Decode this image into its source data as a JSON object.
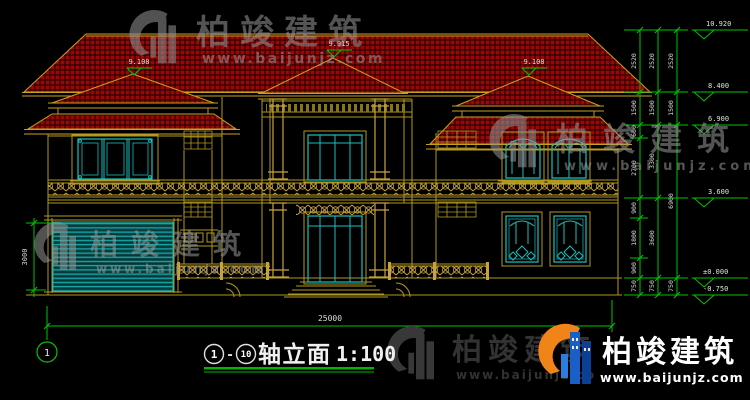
{
  "watermark": {
    "brand": "柏竣建筑",
    "url": "www.baijunjz.com"
  },
  "logo": {
    "brand": "柏竣建筑",
    "url": "www.baijunjz.com"
  },
  "title_block": {
    "axis_start": "1",
    "separator": "-",
    "axis_end": "10",
    "name": "轴立面",
    "scale": "1:100"
  },
  "axis": {
    "bottom_left": "1"
  },
  "dims": {
    "total_width": "25000",
    "garage_height": "3000"
  },
  "elevations": {
    "roof": [
      "9.108",
      "9.915",
      "9.108"
    ],
    "right": [
      "10.920",
      "8.400",
      "6.900",
      "3.600",
      "±0.000",
      "-0.750"
    ]
  },
  "chains": {
    "inner": [
      "2520",
      "1500",
      "600",
      "2700",
      "900",
      "1800",
      "900",
      "750"
    ],
    "middle": [
      "2520",
      "1500",
      "3300",
      "3600",
      "750"
    ],
    "outer": [
      "2520",
      "1500",
      "6900",
      "750"
    ]
  },
  "colors": {
    "background": "#000000",
    "roof_tile": "#9e0505",
    "trim_yellow": "#c8a020",
    "wall_yellow": "#b0981e",
    "railing_gold": "#c8a23c",
    "window_cyan": "#17c0c0",
    "dimension_green": "#00c400",
    "label_white": "#dddddd",
    "logo_blue": "#1a5fc8",
    "logo_orange": "#f08418"
  }
}
